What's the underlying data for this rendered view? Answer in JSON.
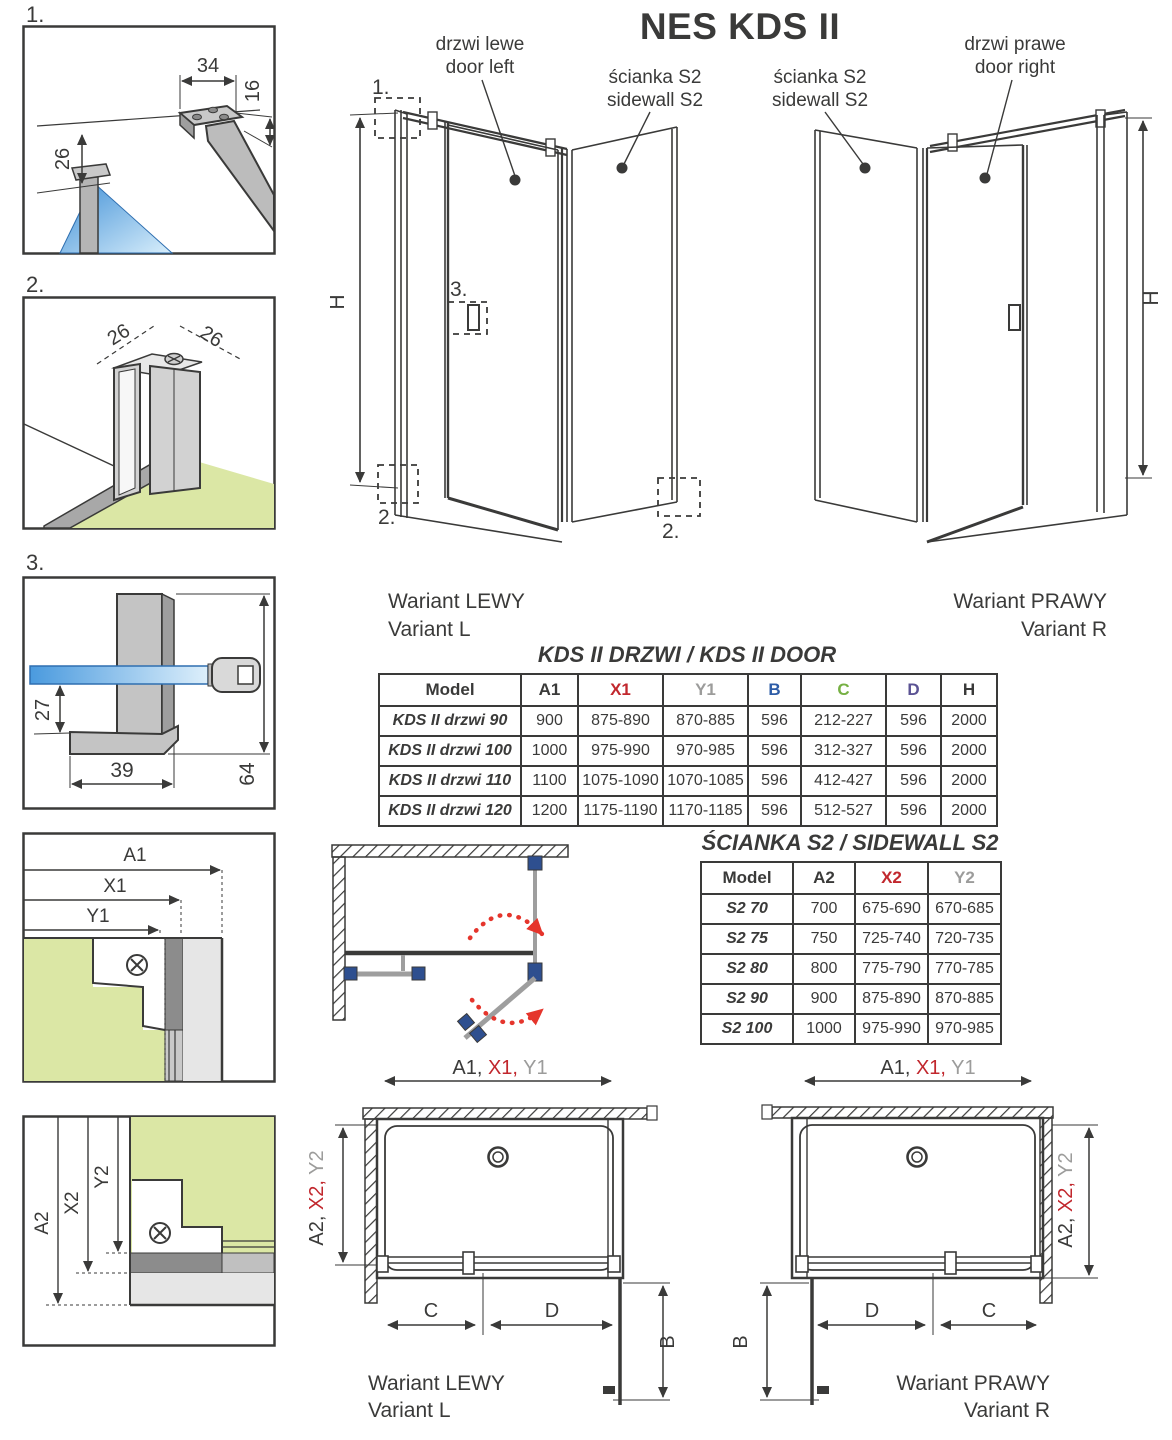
{
  "title": "NES KDS II",
  "top_labels": {
    "door_left": {
      "pl": "drzwi lewe",
      "en": "door left"
    },
    "sidewall_left": {
      "pl": "ścianka S2",
      "en": "sidewall S2"
    },
    "sidewall_right": {
      "pl": "ścianka S2",
      "en": "sidewall S2"
    },
    "door_right": {
      "pl": "drzwi prawe",
      "en": "door right"
    }
  },
  "variants": {
    "left": {
      "pl": "Wariant LEWY",
      "en": "Variant L"
    },
    "right": {
      "pl": "Wariant PRAWY",
      "en": "Variant R"
    }
  },
  "dim_h": "H",
  "markers": {
    "one": "1.",
    "two": "2.",
    "three": "3."
  },
  "detail1": {
    "num": "1.",
    "width": "34",
    "depth": "16",
    "offset": "26"
  },
  "detail2": {
    "num": "2.",
    "left": "26",
    "right": "26"
  },
  "detail3": {
    "num": "3.",
    "inset": "27",
    "foot": "39",
    "height": "64"
  },
  "panel_a1": {
    "a1": "A1",
    "x1": "X1",
    "y1": "Y1"
  },
  "panel_a2": {
    "a2": "A2",
    "x2": "X2",
    "y2": "Y2"
  },
  "plan_dims": {
    "a1": "A1, ",
    "x1": "X1, ",
    "y1": "Y1",
    "a2": "A2, ",
    "x2": "X2, ",
    "y2": "Y2",
    "b": "B",
    "c": "C",
    "d": "D"
  },
  "colors": {
    "ink": "#3a3a39",
    "red": "#c1272d",
    "gray": "#9c9c9b",
    "blue": "#2d5ca7",
    "green": "#76b043",
    "purple": "#5b5394",
    "arrow_red": "#e5352c",
    "floor_green": "#dbe7a5",
    "fitting_blue": "#2e4f8f"
  },
  "door_table": {
    "title": "KDS II DRZWI / KDS II DOOR",
    "headers": [
      {
        "label": "Model",
        "color": "#3a3a39"
      },
      {
        "label": "A1",
        "color": "#3a3a39"
      },
      {
        "label": "X1",
        "color": "#c1272d"
      },
      {
        "label": "Y1",
        "color": "#9c9c9b"
      },
      {
        "label": "B",
        "color": "#2d5ca7"
      },
      {
        "label": "C",
        "color": "#76b043"
      },
      {
        "label": "D",
        "color": "#5b5394"
      },
      {
        "label": "H",
        "color": "#3a3a39"
      }
    ],
    "rows": [
      [
        "KDS II drzwi 90",
        "900",
        "875-890",
        "870-885",
        "596",
        "212-227",
        "596",
        "2000"
      ],
      [
        "KDS II drzwi 100",
        "1000",
        "975-990",
        "970-985",
        "596",
        "312-327",
        "596",
        "2000"
      ],
      [
        "KDS II drzwi 110",
        "1100",
        "1075-1090",
        "1070-1085",
        "596",
        "412-427",
        "596",
        "2000"
      ],
      [
        "KDS II drzwi 120",
        "1200",
        "1175-1190",
        "1170-1185",
        "596",
        "512-527",
        "596",
        "2000"
      ]
    ]
  },
  "sidewall_table": {
    "title": "ŚCIANKA S2 / SIDEWALL S2",
    "headers": [
      {
        "label": "Model",
        "color": "#3a3a39"
      },
      {
        "label": "A2",
        "color": "#3a3a39"
      },
      {
        "label": "X2",
        "color": "#c1272d"
      },
      {
        "label": "Y2",
        "color": "#9c9c9b"
      }
    ],
    "rows": [
      [
        "S2 70",
        "700",
        "675-690",
        "670-685"
      ],
      [
        "S2 75",
        "750",
        "725-740",
        "720-735"
      ],
      [
        "S2 80",
        "800",
        "775-790",
        "770-785"
      ],
      [
        "S2 90",
        "900",
        "875-890",
        "870-885"
      ],
      [
        "S2 100",
        "1000",
        "975-990",
        "970-985"
      ]
    ]
  }
}
